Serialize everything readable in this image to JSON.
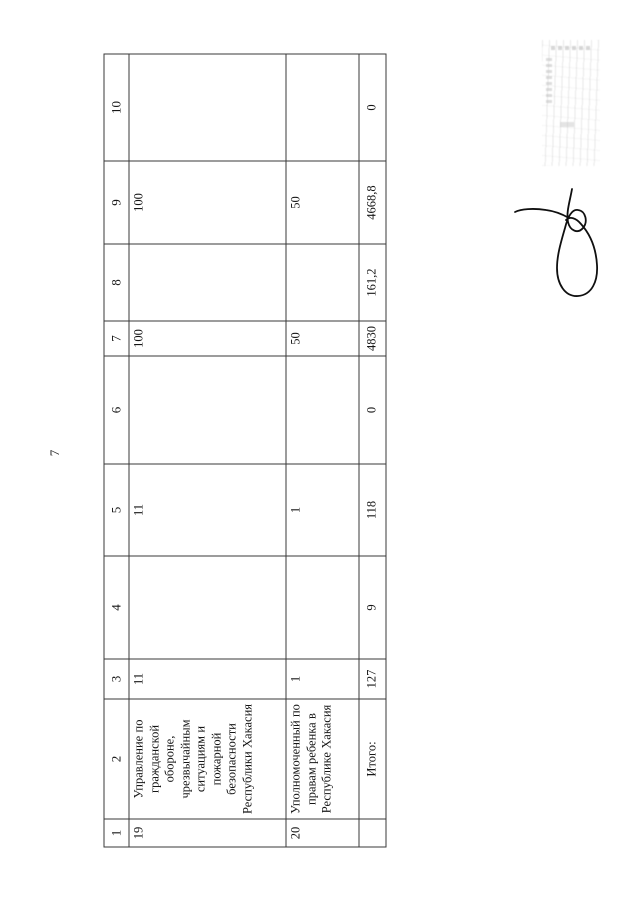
{
  "page": {
    "number": "7"
  },
  "table": {
    "headers": [
      "1",
      "2",
      "3",
      "4",
      "5",
      "6",
      "7",
      "8",
      "9",
      "10"
    ],
    "rows": [
      [
        "19",
        "Управление по гражданской обороне, чрезвычайным ситуациям и пожарной безопасности Республики Хакасия",
        "11",
        "",
        "11",
        "",
        "100",
        "",
        "100",
        ""
      ],
      [
        "20",
        "Уполномоченный по правам ребенка в Республике Хакасия",
        "1",
        "",
        "1",
        "",
        "50",
        "",
        "50",
        ""
      ],
      [
        "",
        "Итого:",
        "127",
        "9",
        "118",
        "0",
        "4830",
        "161,2",
        "4668,8",
        "0"
      ]
    ]
  },
  "artifacts": {
    "stamp_icon": "illegible-stamp",
    "signature_icon": "handwritten-signature",
    "ink_color": "#101010"
  }
}
